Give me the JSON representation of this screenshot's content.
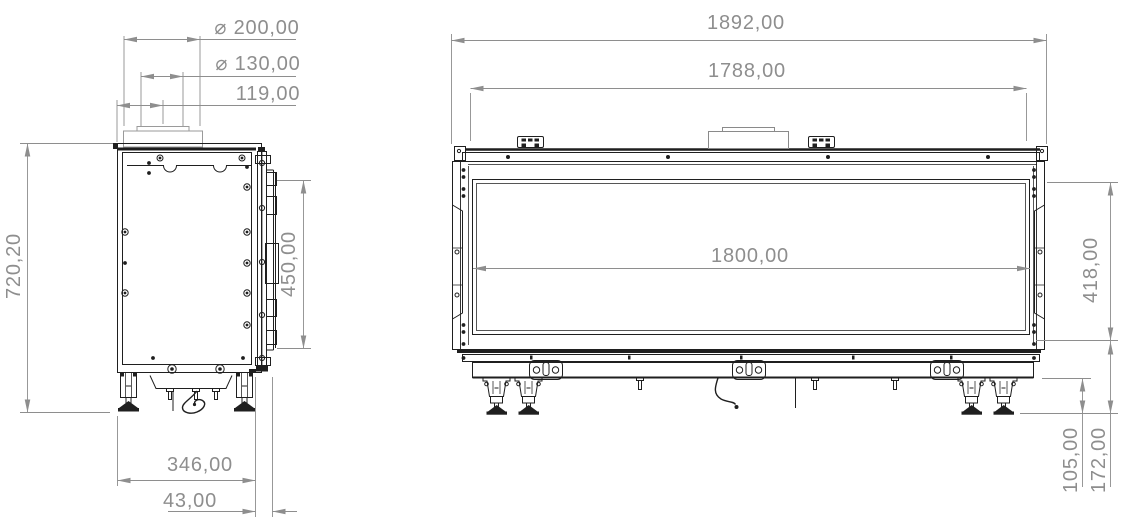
{
  "side_view": {
    "title": "side elevation",
    "dimensions": {
      "flue_outer_diameter": "⌀ 200,00",
      "flue_inner_diameter": "⌀ 130,00",
      "flue_center_offset": "119,00",
      "overall_height": "720,20",
      "glass_opening_height": "450,00",
      "body_depth": "346,00",
      "glass_front_offset": "43,00"
    }
  },
  "front_view": {
    "title": "front elevation",
    "dimensions": {
      "overall_width": "1892,00",
      "body_width": "1788,00",
      "glass_opening_width": "1800,00",
      "glass_opening_height": "418,00",
      "leg_height": "105,00",
      "base_height": "172,00"
    }
  },
  "style": {
    "line_color": "#1f1f1f",
    "dimension_color": "#8e8e8e",
    "background": "#ffffff"
  }
}
